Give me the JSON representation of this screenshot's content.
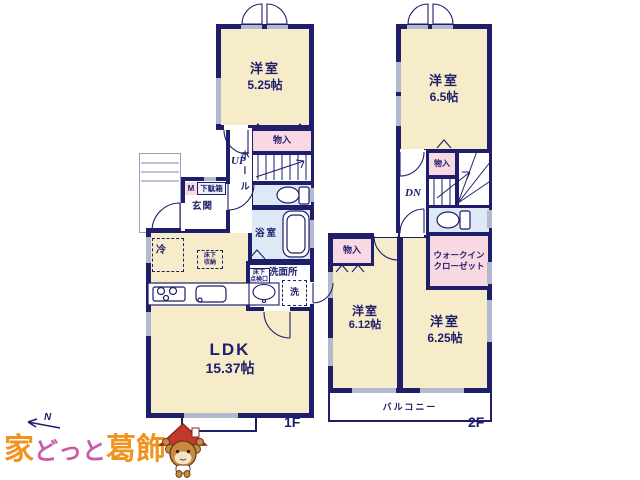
{
  "colors": {
    "wall_navy": "#1e1e6b",
    "room_cream": "#f6ecc9",
    "closet_pink": "#f8d9e3",
    "wet_blue": "#dfe9f6",
    "window_grey": "#b3b9ce",
    "logo_orange": "#f0941f",
    "logo_pink": "#c75da8",
    "mascot_red": "#c0392b"
  },
  "compass": {
    "n": "N"
  },
  "floor1": {
    "caption": "1F",
    "main_room": {
      "name": "洋室",
      "area": "5.25帖"
    },
    "closet": "物入",
    "stairs": "UP",
    "hall": "ホール",
    "entrance": "玄関",
    "shoe_cabinet_m": "M",
    "shoe_cabinet": "下駄箱",
    "bathroom": "浴室",
    "washroom": "洗面所",
    "washer": "洗",
    "fridge": "冷",
    "underfloor_storage_l1": "床下",
    "underfloor_storage_l2": "収納",
    "underfloor_hatch_l1": "床下",
    "underfloor_hatch_l2": "点検口",
    "ldk": {
      "name": "LDK",
      "area": "15.37帖"
    }
  },
  "floor2": {
    "caption": "2F",
    "top_room": {
      "name": "洋室",
      "area": "6.5帖"
    },
    "closet_top": "物入",
    "stairs": "DN",
    "closet_left": "物入",
    "wic_l1": "ウォークイン",
    "wic_l2": "クローゼット",
    "left_room": {
      "name": "洋室",
      "area": "6.12帖"
    },
    "right_room": {
      "name": "洋室",
      "area": "6.25帖"
    },
    "balcony": "バルコニー"
  },
  "logo": {
    "part1": "家",
    "part2": "どっと",
    "part3": "葛飾"
  }
}
